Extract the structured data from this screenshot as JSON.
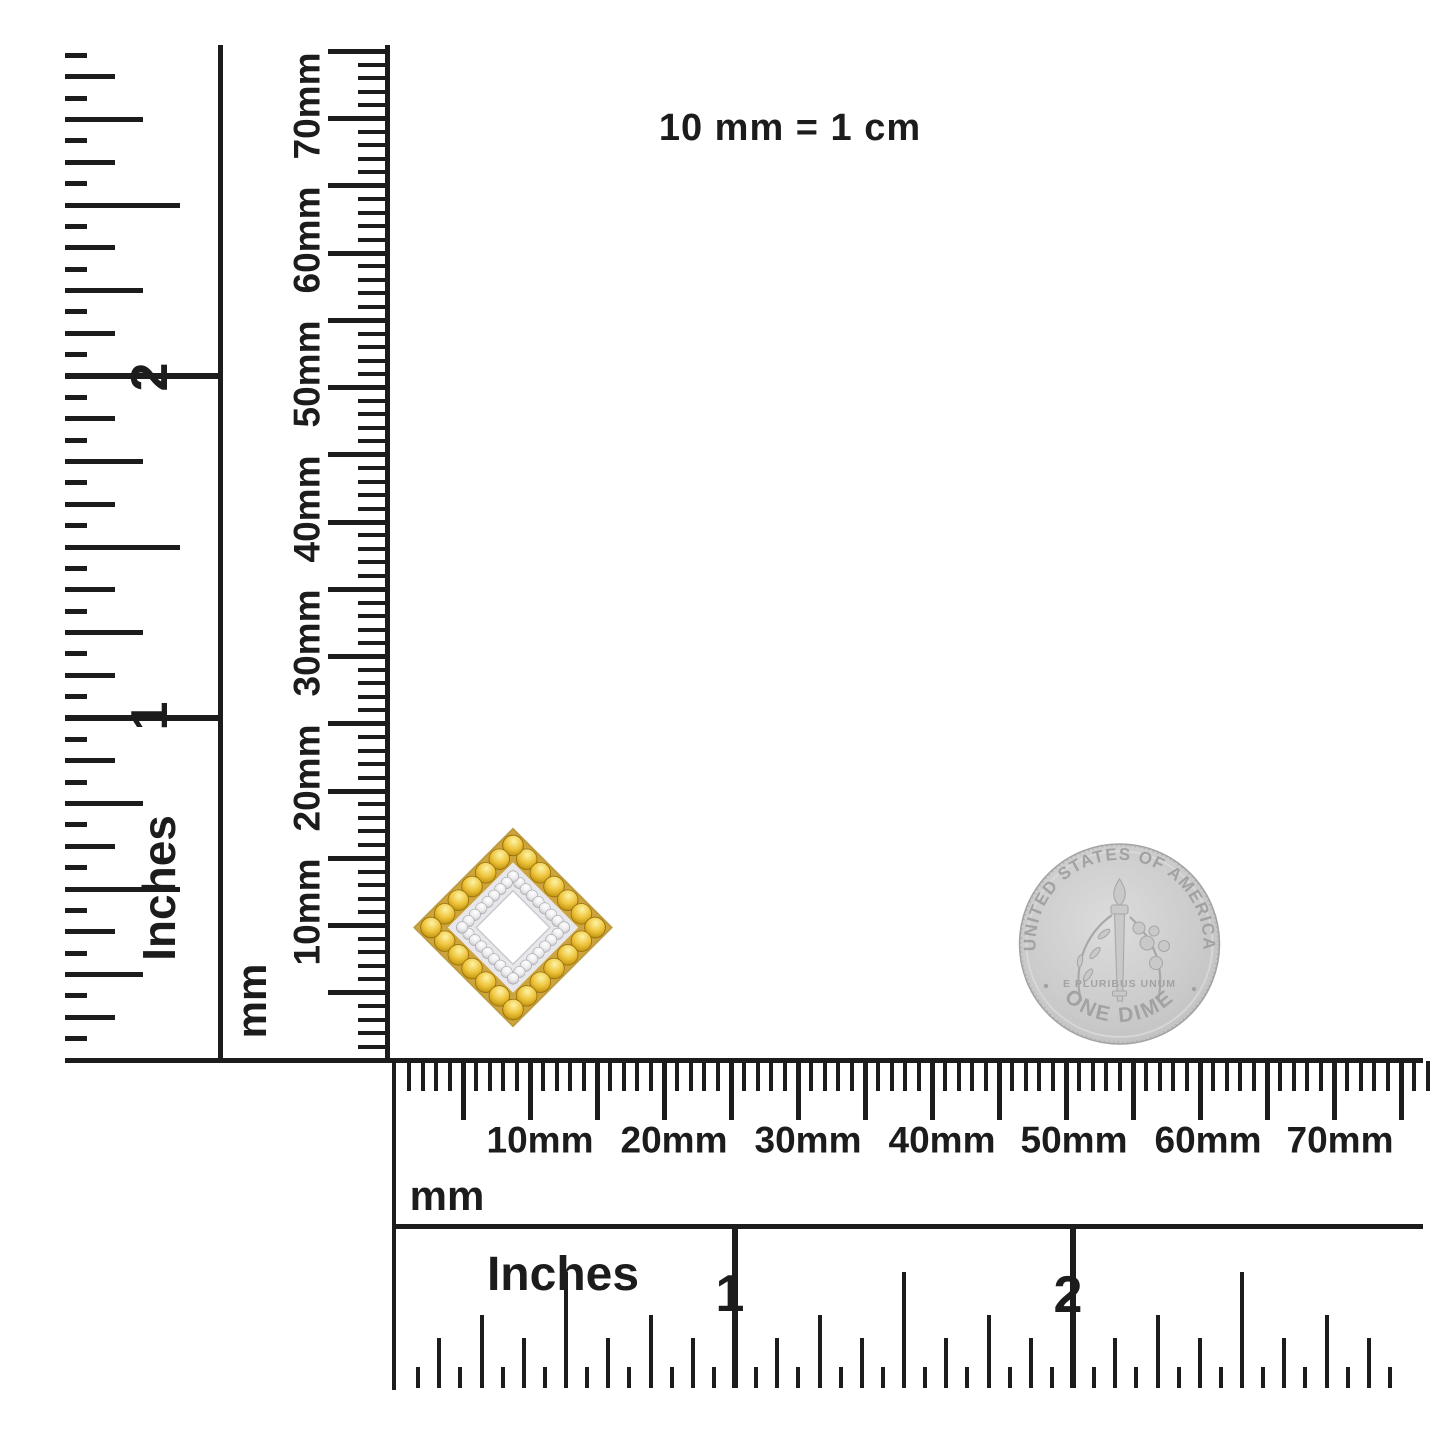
{
  "scale_note": {
    "text": "10 mm = 1 cm"
  },
  "left_inch_ruler": {
    "unit_label": "Inches",
    "numbers": [
      "1",
      "2"
    ]
  },
  "left_mm_ruler": {
    "unit_label": "mm",
    "labels": [
      "10mm",
      "20mm",
      "30mm",
      "40mm",
      "50mm",
      "60mm",
      "70mm"
    ]
  },
  "bottom_mm_ruler": {
    "unit_label": "mm",
    "labels": [
      "10mm",
      "20mm",
      "30mm",
      "40mm",
      "50mm",
      "60mm",
      "70mm"
    ]
  },
  "bottom_inch_ruler": {
    "unit_label": "Inches",
    "numbers": [
      "1",
      "2"
    ]
  },
  "coin": {
    "top_text": "UNITED STATES OF AMERICA",
    "bottom_text": "ONE DIME",
    "motto": "E PLURIBUS UNUM"
  },
  "colors": {
    "ink": "#1c1c1c",
    "gem_yellow_hi": "#fdf3a6",
    "gem_yellow_mid": "#eec33a",
    "gem_yellow_lo": "#bb8d0b",
    "gem_yellow_edge": "#96700a",
    "gold_metal": "#cda43e",
    "gold_edge": "#a9841f",
    "white_metal": "#e8e8ec",
    "gem_white_hi": "#ffffff",
    "gem_white_mid": "#ebebee",
    "gem_white_lo": "#bdbdc2",
    "gem_white_edge": "#9a9aa0",
    "coin_body_hi": "#dcdcdc",
    "coin_body_mid": "#cbcbcb",
    "coin_body_lo": "#bdbdbd",
    "coin_edge": "#a3a3a3",
    "coin_text": "#a2a2a2",
    "coin_relief_fill": "#c9c9c9",
    "coin_relief_line": "#a8a8a8"
  }
}
